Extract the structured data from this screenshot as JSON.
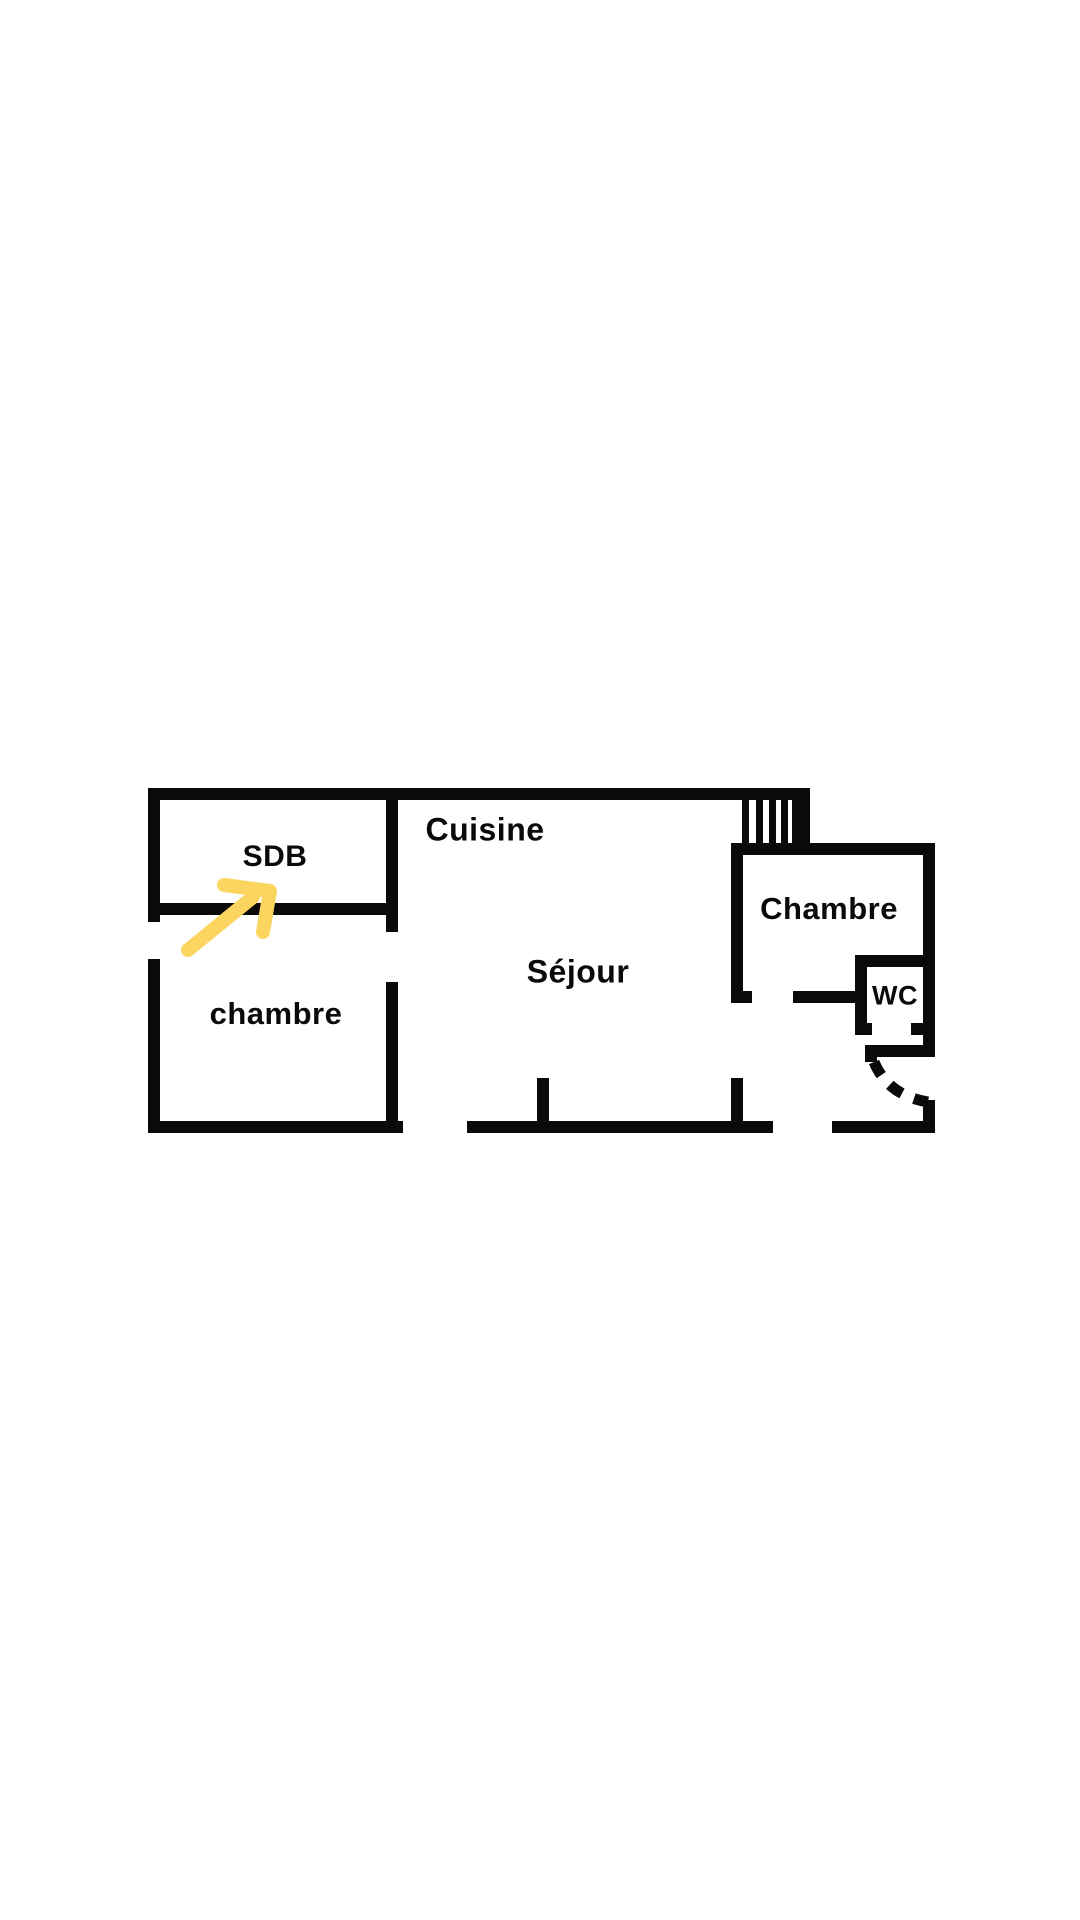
{
  "colors": {
    "background": "#ffffff",
    "wall": "#0a0a0a",
    "text": "#0a0a0a",
    "arrow": "#fbd55f"
  },
  "floorplan": {
    "rooms": [
      {
        "id": "sdb",
        "label": "SDB"
      },
      {
        "id": "cuisine",
        "label": "Cuisine"
      },
      {
        "id": "sejour",
        "label": "Séjour"
      },
      {
        "id": "chambre_left",
        "label": "chambre"
      },
      {
        "id": "chambre_right",
        "label": "Chambre"
      },
      {
        "id": "wc",
        "label": "WC"
      }
    ],
    "annotations": [
      {
        "id": "highlight-arrow",
        "type": "arrow",
        "color": "#fbd55f",
        "target_room": "SDB"
      }
    ]
  }
}
